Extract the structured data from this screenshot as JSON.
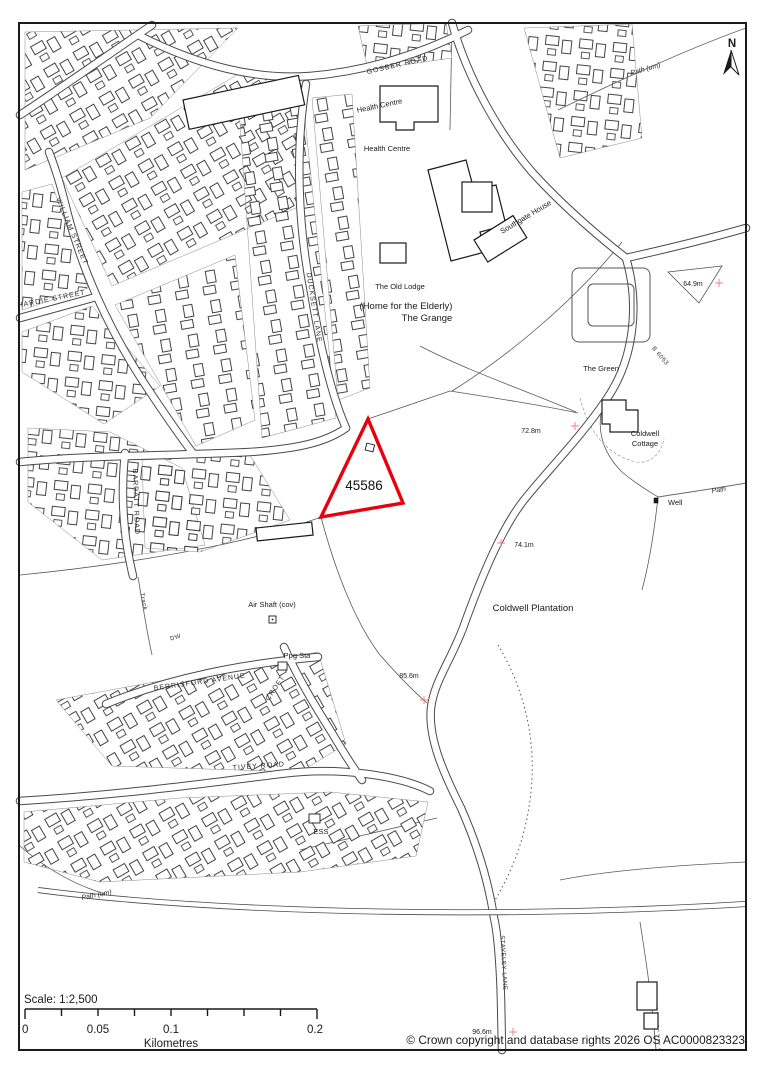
{
  "map": {
    "parcel": {
      "id": "45586",
      "outline_color": "#e8000d"
    },
    "streets": {
      "gosber_road": "GOSBER ROAD",
      "william_street": "WILLIAM STREET",
      "hardie_street": "HARDIE STREET",
      "ducksett_lane": "DUCKSETT LANE",
      "barratt_road": "BARRATT ROAD",
      "berrisford_avenue": "BERRISFORD AVENUE",
      "croft": "CROFT",
      "tivey_road": "TIVEY ROAD",
      "staveley_lane": "STAVELEY LANE",
      "b_road": "B 6053",
      "track": "Track",
      "dw": "DW"
    },
    "places": {
      "health_centre_1": "Health Centre",
      "health_centre_2": "Health Centre",
      "southgate_house": "Southgate House",
      "the_old_lodge": "The Old Lodge",
      "home_for_elderly": "(Home for the Elderly)",
      "the_grange": "The Grange",
      "the_green": "The Green",
      "coldwell_cottage_line1": "Coldwell",
      "coldwell_cottage_line2": "Cottage",
      "well": "Well",
      "coldwell_plantation": "Coldwell Plantation",
      "air_shaft": "Air Shaft (cov)",
      "ppg_sta": "Ppg Sta",
      "ess": "ESS"
    },
    "paths": {
      "path_um_ne": "Path (um)",
      "path_um_sw": "Path (um)",
      "path_east": "Path"
    },
    "elevations": {
      "e1": "64.9m",
      "e2": "72.8m",
      "e3": "74.1m",
      "e4": "85.6m",
      "e5": "96.6m"
    },
    "north": {
      "label": "N"
    }
  },
  "scale_bar": {
    "scale_text": "Scale: 1:2,500",
    "tick_labels": [
      "0",
      "0.05",
      "0.1",
      "0.2"
    ],
    "unit_label": "Kilometres"
  },
  "footer": {
    "copyright": "© Crown copyright and database rights 2026 OS AC0000823323"
  },
  "colors": {
    "parcel_outline": "#e8000d",
    "grid_cross": "#f4837d",
    "map_line": "#2b2b2b",
    "background": "#ffffff"
  }
}
